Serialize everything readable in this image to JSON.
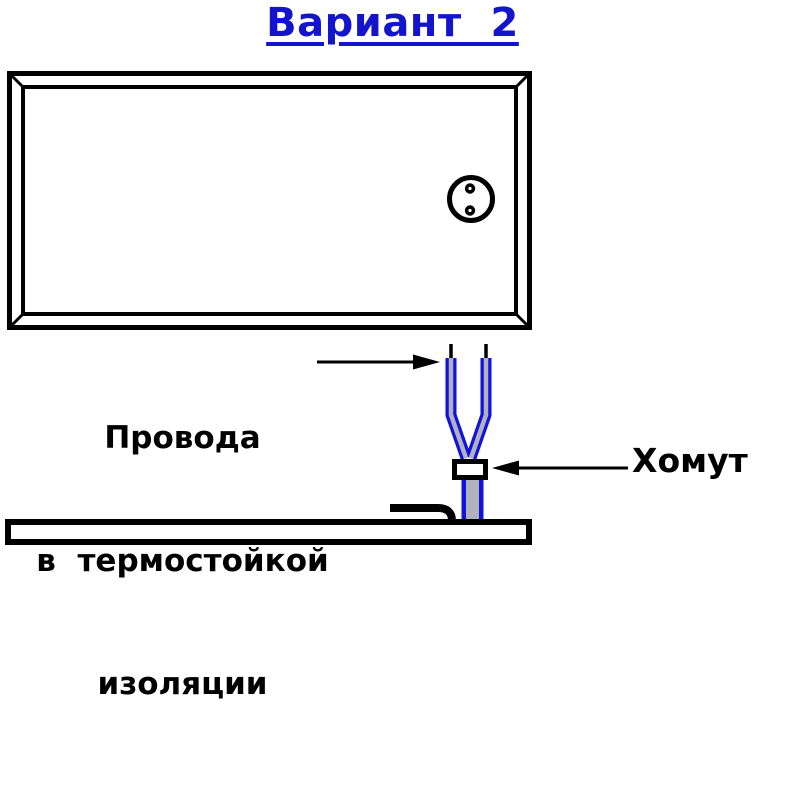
{
  "title": {
    "text": "Вариант  2"
  },
  "annotations": {
    "wires_label": {
      "line1": "Провода",
      "line2": "в  термостойкой",
      "line3": "изоляции"
    },
    "clamp_label": {
      "text": "Хомут"
    }
  },
  "diagram": {
    "parts": [
      "panel-frame",
      "socket",
      "heat-resistant-wires",
      "wire-bare-tips",
      "clamp",
      "cable",
      "cable-elbow",
      "base-panel"
    ]
  },
  "colors": {
    "title_blue": "#1414cc",
    "wire_blue": "#1212dd",
    "wire_core_gray": "#b2b2bf",
    "line_black": "#000000",
    "background": "#ffffff"
  }
}
